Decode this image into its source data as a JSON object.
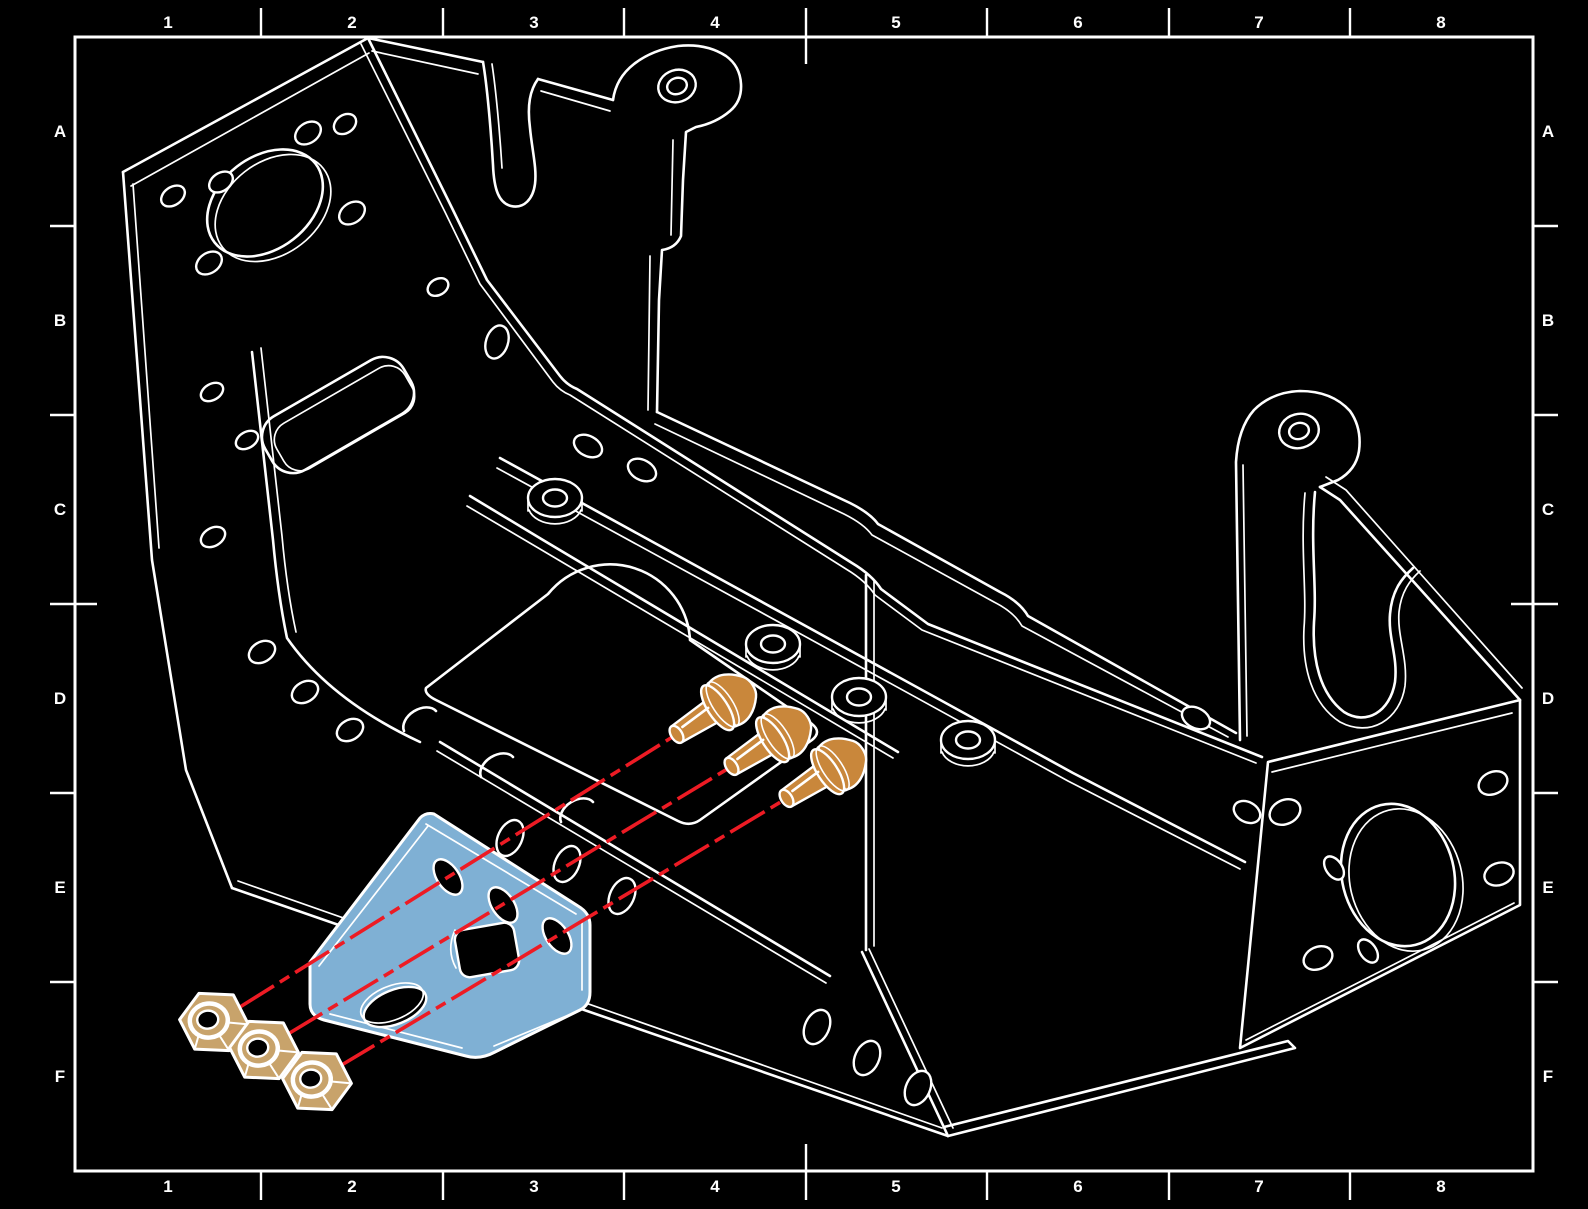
{
  "drawing": {
    "type": "exploded-assembly-cad-drawing",
    "grid": {
      "columns": [
        "1",
        "2",
        "3",
        "4",
        "5",
        "6",
        "7",
        "8"
      ],
      "rows": [
        "A",
        "B",
        "C",
        "D",
        "E",
        "F"
      ]
    },
    "colors": {
      "background": "#000000",
      "line_work": "#FFFFFF",
      "highlighted_part": "#7FB0D4",
      "screw": "#C9873B",
      "nut": "#C8A36B",
      "centerline": "#ED1B24"
    },
    "components": {
      "frame": "sheet-metal-chassis",
      "highlighted_part": "mounting-angle-bracket",
      "fasteners": "pan-head-screws-x3",
      "nuts": "hex-nuts-x3",
      "centerlines": "assembly-centerlines-x3"
    }
  }
}
